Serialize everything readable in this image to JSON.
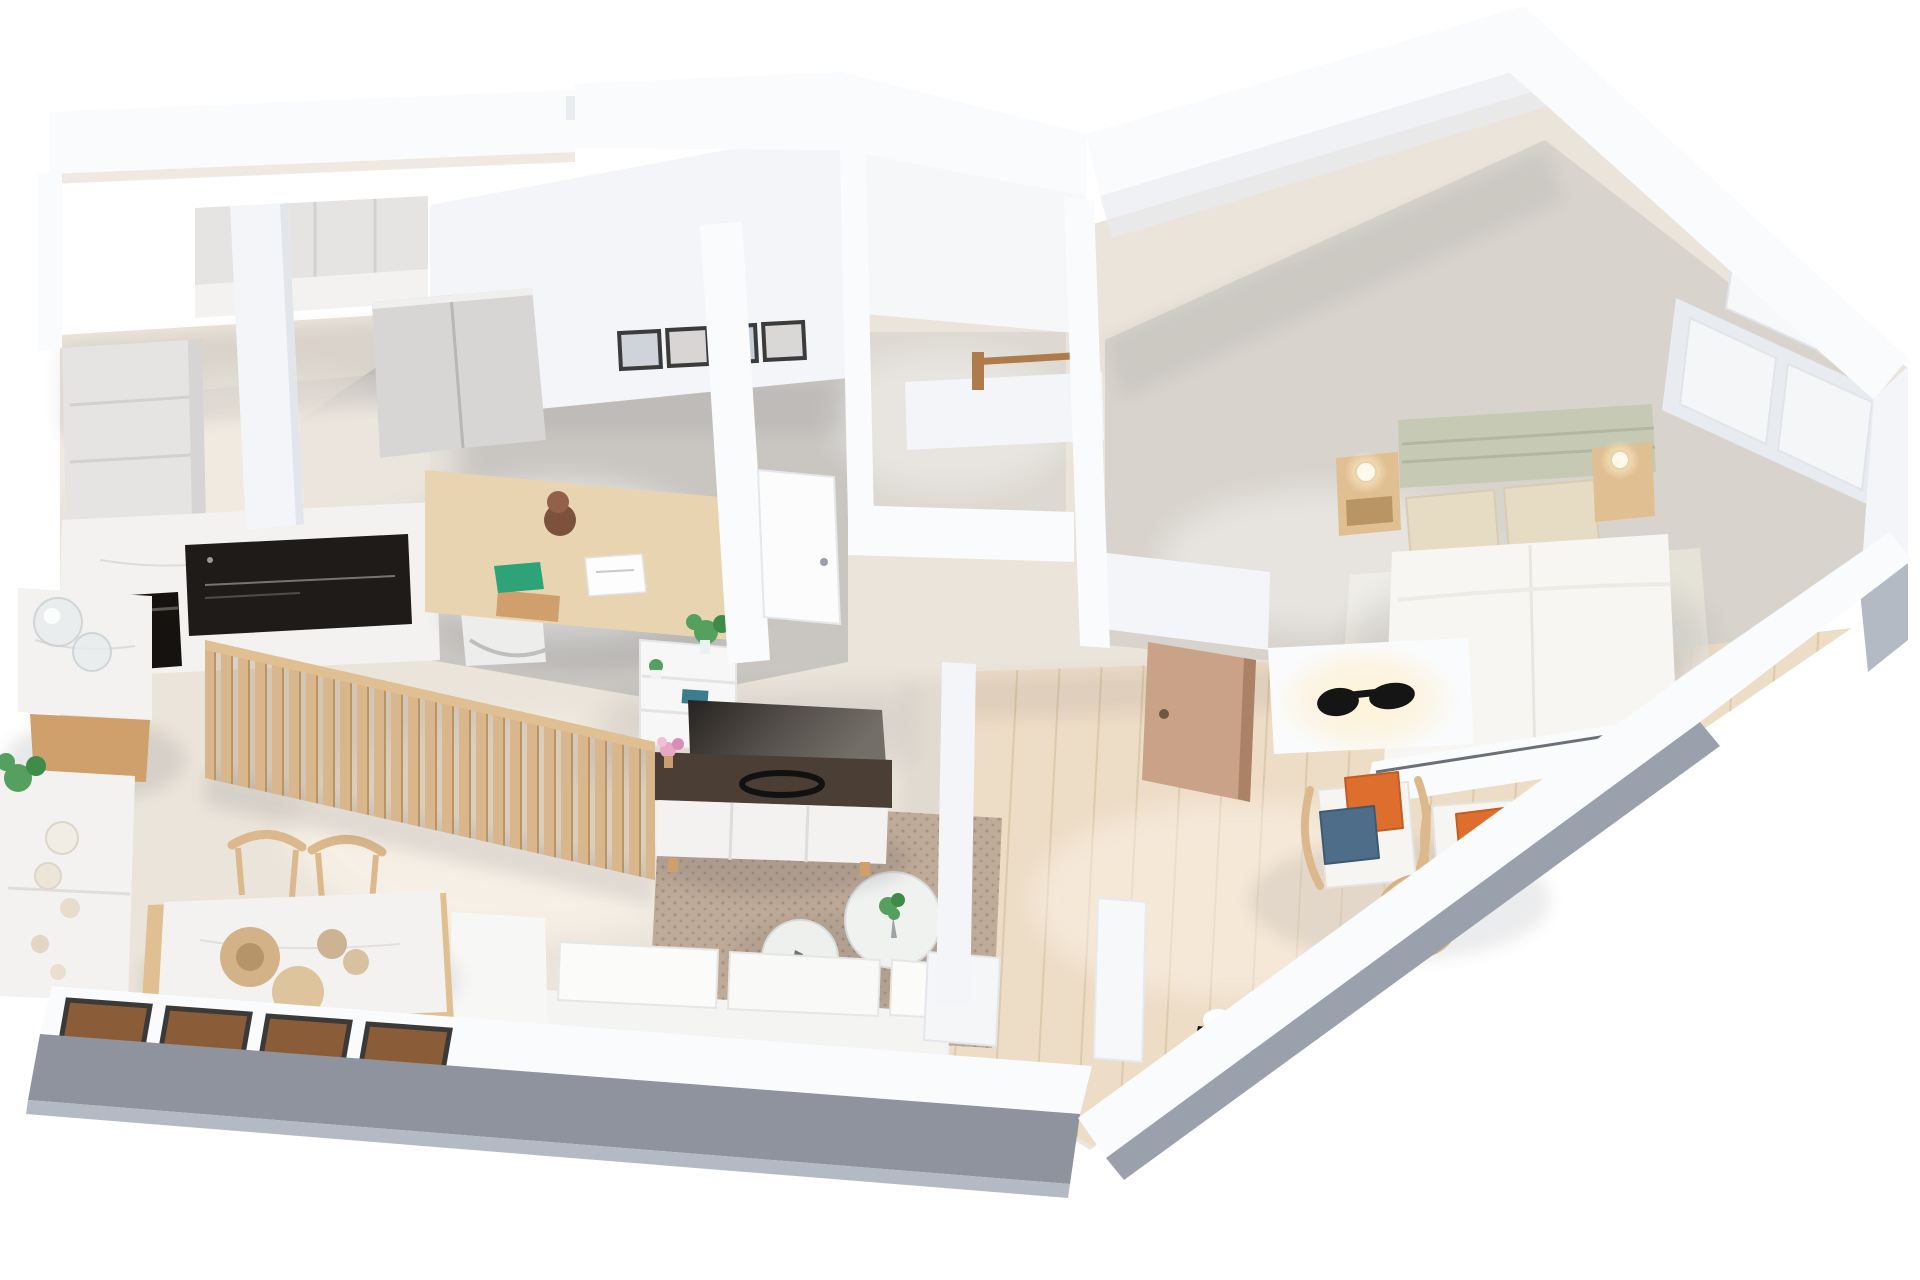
{
  "scene": {
    "title": "3D axonometric floor plan render of a one-bedroom apartment with kitchen, study, bathroom, living room, bedroom and terrace",
    "background": "#ffffff"
  },
  "palette": {
    "wallWhite": "#fafbfc",
    "wallFace": "#f3f5f8",
    "wallShade": "#e8ebf0",
    "wallEdge": "#dfe3ea",
    "outerGray": "#8e939e",
    "outerGrayLight": "#b4bac4",
    "floorBase": "#ebe4da",
    "floorOffice": "#c7c4c1",
    "floorBath": "#dcd7d0",
    "carpetBedroom": "#d8d4cd",
    "bedroomRug": "#e9e5db",
    "rugLiving": "#bfab99",
    "rugDot": "#a8917c",
    "terraceWood": "#eddcc6",
    "terracePlankLine": "#ddc9ab",
    "marble": "#f3f2f1",
    "marbleVein": "#dddcda",
    "marbleSide": "#e7e5e2",
    "cabinetGray": "#e5e4e3",
    "cabinetLine": "#d2d1d0",
    "closetGray": "#d8d6d5",
    "woodLight": "#e0bf92",
    "woodMid": "#cfa06b",
    "woodDark": "#8a5f3f",
    "slatWood": "#d9b68b",
    "deskWood": "#e9d4b1",
    "chairWood": "#dcb98c",
    "bowlWood": "#d3b288",
    "cooktopBlack": "#1e1b19",
    "ovenBlack": "#16120f",
    "tvDark": "#2b2724",
    "consoleTop": "#4a3e35",
    "doorTan": "#c9a287",
    "doorTanEdge": "#ab8266",
    "doorWhite": "#fcfcfd",
    "sconceBlack": "#151515",
    "glowWarm": "#ffedc9",
    "headboardSage": "#c6c9b3",
    "pillowBeige": "#e6dcc4",
    "duvetWhite": "#f7f6f3",
    "orangePillow": "#dd6e2e",
    "bluePillow": "#4e6d88",
    "plantGreen": "#55a05e",
    "plantDark": "#3e8b4a",
    "windowBrown": "#8a5c38",
    "windowFrame": "#3c3a38",
    "windowGlass": "#8fa9c4",
    "jarGlass": "#e9ecee",
    "shadow": "#41454f",
    "lightPatch": "#fff8ee"
  },
  "rooms": [
    {
      "id": "kitchen",
      "label": "Kitchen",
      "furniture": [
        "tall cabinet column",
        "upper cabinets with marble counter",
        "induction cooktop",
        "built-in oven",
        "marble island with glass jars",
        "marble sideboard with plant, bowls and shells",
        "dining table with wooden chairs and bowls",
        "four windows in south wall"
      ]
    },
    {
      "id": "study",
      "label": "Study / office nook",
      "furniture": [
        "gray double-door closet",
        "four framed pictures",
        "wooden desk with lamp, papers and green pad",
        "white desk chair",
        "wooden slat partition",
        "white shelving unit with plants and books",
        "TV sideboard with marble drawers",
        "flat TV"
      ]
    },
    {
      "id": "bathroom",
      "label": "Bathroom",
      "furniture": [
        "half wall with wooden towel rail"
      ]
    },
    {
      "id": "hallway",
      "label": "Hallway",
      "furniture": [
        "white interior door"
      ]
    },
    {
      "id": "entry",
      "label": "Entry",
      "furniture": [
        "tan front door",
        "black wall sconce with warm glow",
        "white pedestal",
        "white pillar"
      ]
    },
    {
      "id": "living",
      "label": "Living room",
      "furniture": [
        "speckled area rug",
        "two round white coffee tables with plant",
        "white modular sofa along south wall"
      ]
    },
    {
      "id": "bedroom",
      "label": "Bedroom",
      "furniture": [
        "double bed with sage headboard and beige pillows",
        "two wooden nightstands with glowing lamps",
        "built-in wardrobe niches",
        "sliding glass window at bed foot",
        "light rug"
      ]
    },
    {
      "id": "terrace",
      "label": "Terrace lounge",
      "furniture": [
        "two wooden armchairs with orange and blue cushions",
        "round wooden coffee table with plant",
        "black floor sconce",
        "wood plank decking"
      ]
    }
  ]
}
